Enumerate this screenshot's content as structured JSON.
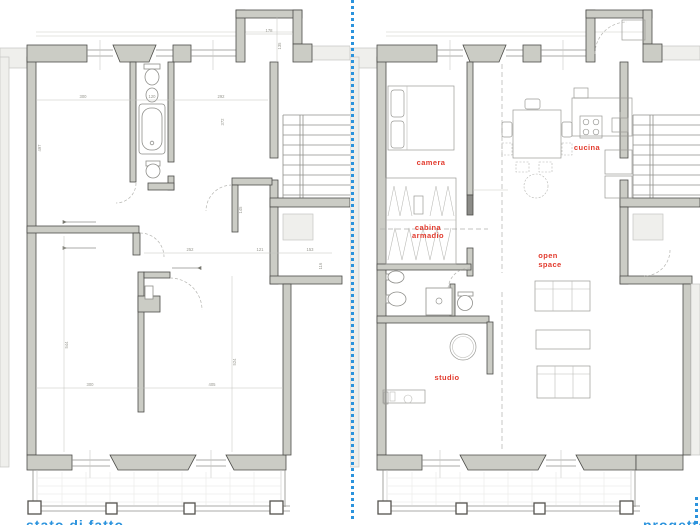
{
  "page": {
    "background": "#ffffff",
    "type": "floor-plan-comparison-drawing"
  },
  "divider": {
    "style": "dotted",
    "color": "#2b93dd"
  },
  "colors": {
    "wall_fill": "#cbccc5",
    "wall_stroke": "#4d4d49",
    "outside_fill": "#efefec",
    "thin_line": "#8f8f8b",
    "label_red": "#e23b2e",
    "dim_gray": "#97978f",
    "caption_blue": "#2b93dd"
  },
  "left_plan": {
    "name": "existing floor plan",
    "dims": {
      "w1": "300",
      "w2": "120",
      "w3": "292",
      "h_left": "497",
      "h_room2": "372",
      "bay_w": "178",
      "bay_h": "135",
      "hall_h": "145",
      "m1": "252",
      "m2": "121",
      "m3": "153",
      "niche_h": "116",
      "back_h1": "544",
      "back_h2": "524",
      "b1": "300",
      "b2": "405"
    }
  },
  "right_plan": {
    "name": "project floor plan",
    "rooms": {
      "camera": "camera",
      "cucina": "cucina",
      "cabina_line1": "cabina",
      "cabina_line2": "armadio",
      "open_line1": "open",
      "open_line2": "space",
      "studio": "studio"
    }
  },
  "captions": {
    "left": "stato di fatto",
    "right": "progetto"
  }
}
